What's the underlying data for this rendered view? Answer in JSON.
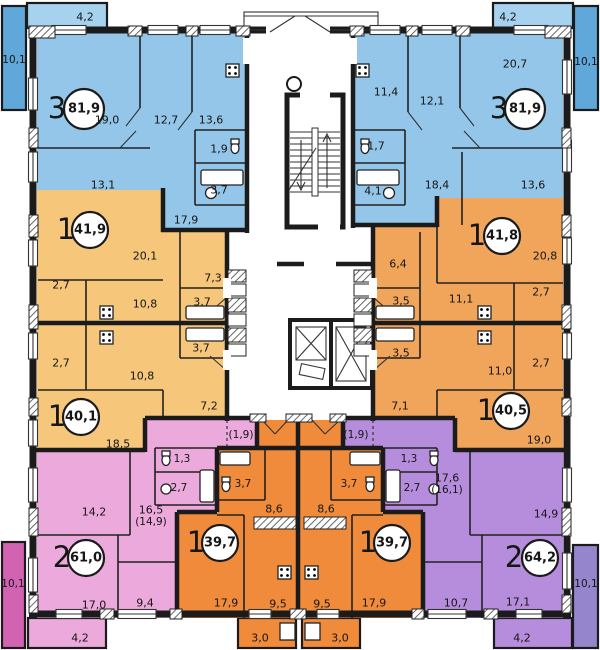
{
  "colors": {
    "apartment_3_room": "#93c6e8",
    "balcony_blue": "#5fa8d9",
    "balcony_blue_light": "#a6d2ef",
    "apartment_1_room_left": "#f6c77b",
    "apartment_1_room_right": "#f0a55b",
    "apartment_1_room_center": "#ef8b3b",
    "apartment_2_room_left": "#eba9dc",
    "balcony_magenta": "#d263b3",
    "apartment_2_room_right": "#b68ddc",
    "balcony_purple": "#9485cc",
    "wall": "#1b1b1b"
  },
  "apartments": [
    {
      "name": "3-room-top-left",
      "type": "3",
      "area": "81,9",
      "rooms": [
        "19,0",
        "12,7",
        "13,6",
        "1,9",
        "3,7",
        "13,1",
        "17,9"
      ]
    },
    {
      "name": "3-room-top-right",
      "type": "3",
      "area": "81,9",
      "rooms": [
        "20,7",
        "11,4",
        "12,1",
        "1,7",
        "4,1",
        "18,4",
        "13,6"
      ]
    },
    {
      "name": "1-room-mid-left-upper",
      "type": "1",
      "area": "41,9",
      "rooms": [
        "20,1",
        "2,7",
        "10,8",
        "3,7",
        "7,3"
      ]
    },
    {
      "name": "1-room-mid-right-upper",
      "type": "1",
      "area": "41,8",
      "rooms": [
        "20,8",
        "6,4",
        "3,5",
        "11,1",
        "2,7"
      ]
    },
    {
      "name": "1-room-mid-left-lower",
      "type": "1",
      "area": "40,1",
      "rooms": [
        "2,7",
        "10,8",
        "3,7",
        "7,2",
        "18,5"
      ]
    },
    {
      "name": "1-room-mid-right-lower",
      "type": "1",
      "area": "40,5",
      "rooms": [
        "3,5",
        "11,0",
        "2,7",
        "7,1",
        "19,0"
      ]
    },
    {
      "name": "2-room-bottom-left",
      "type": "2",
      "area": "61,0",
      "rooms": [
        "(1,9)",
        "1,3",
        "2,7",
        "14,2",
        "16,5",
        "(14,9)",
        "17,0",
        "9,4"
      ]
    },
    {
      "name": "2-room-bottom-right",
      "type": "2",
      "area": "64,2",
      "rooms": [
        "(1,9)",
        "1,3",
        "2,7",
        "17,6",
        "(16,1)",
        "14,9",
        "10,7",
        "17,1"
      ]
    },
    {
      "name": "1-room-bottom-center-left",
      "type": "1",
      "area": "39,7",
      "rooms": [
        "3,7",
        "8,6",
        "17,9",
        "9,5"
      ]
    },
    {
      "name": "1-room-bottom-center-right",
      "type": "1",
      "area": "39,7",
      "rooms": [
        "3,7",
        "8,6",
        "9,5",
        "17,9"
      ]
    }
  ],
  "balconies": {
    "top_left_top": "4,2",
    "top_left_side": "10,1",
    "top_right_top": "4,2",
    "top_right_side": "10,1",
    "bottom_left_side": "10,1",
    "bottom_left": "4,2",
    "center_left": "3,0",
    "center_right": "3,0",
    "bottom_right": "4,2",
    "bottom_right_side": "10,1"
  }
}
